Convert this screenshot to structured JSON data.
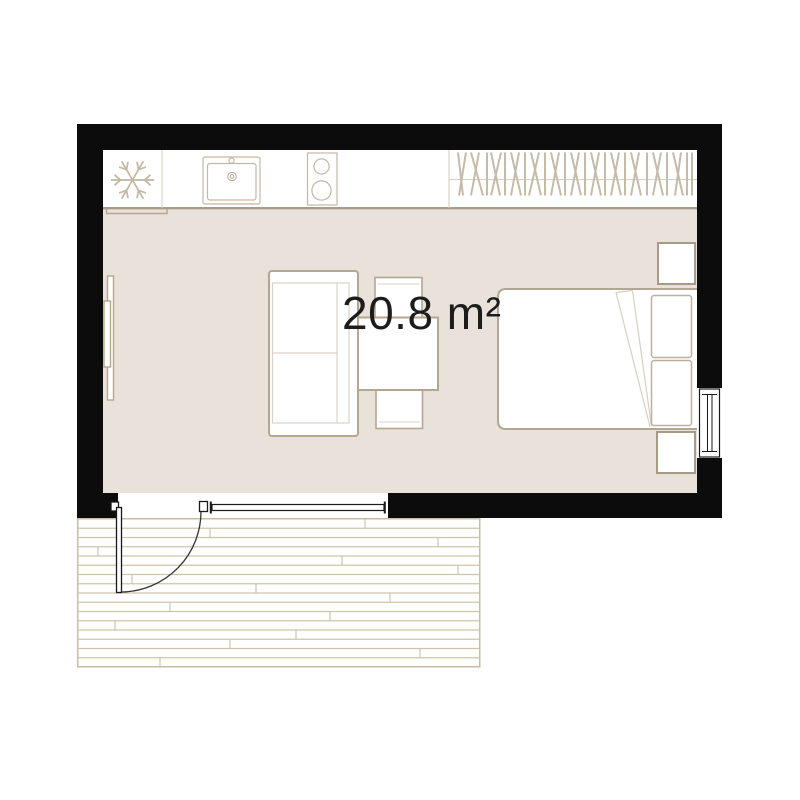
{
  "plan": {
    "area_label": "20.8 m²"
  },
  "colors": {
    "wall": "#0c0c0c",
    "floor": "#e8e2da",
    "fixture_outline": "#b3a692",
    "fixture_outline_light": "#d8d0c3",
    "hatch": "#c6baa9",
    "deck_line": "#cfc4aa",
    "door_line": "#1a1a1a",
    "label_text": "#1c1c1c",
    "background": "#ffffff"
  },
  "fixtures": [
    "refrigerator",
    "kitchen-sink",
    "cooktop",
    "wardrobe",
    "sofa",
    "coffee-table",
    "stool",
    "double-bed",
    "pillow",
    "nightstand",
    "radiator",
    "window",
    "entry-door",
    "terrace-deck"
  ]
}
